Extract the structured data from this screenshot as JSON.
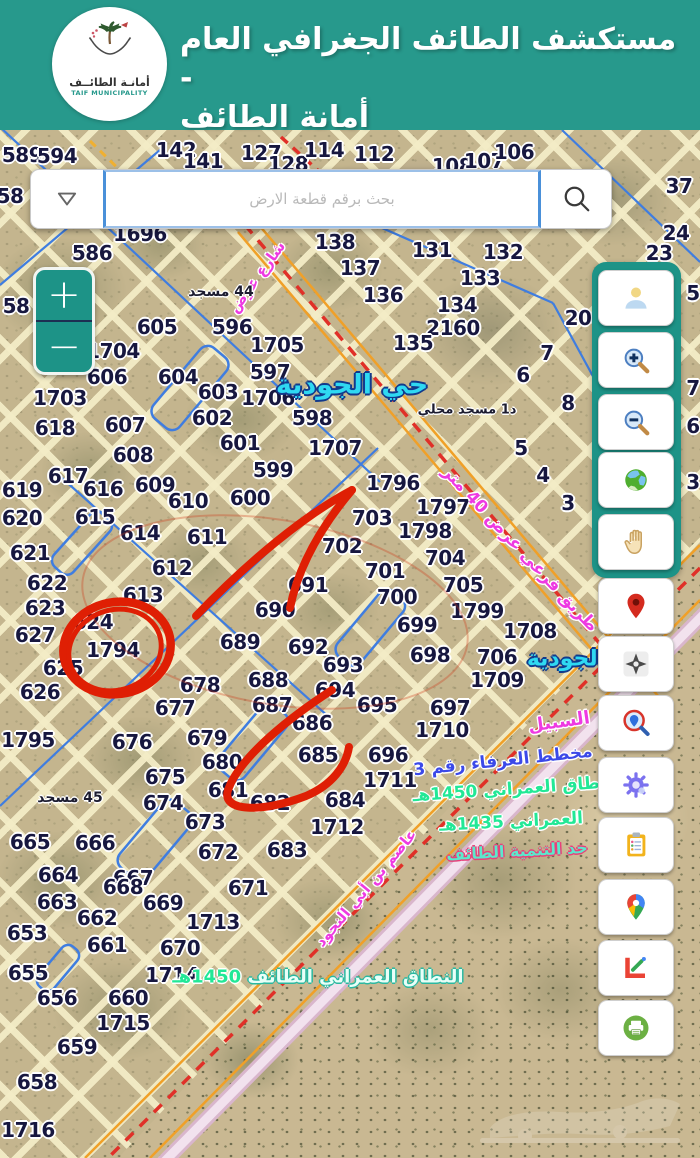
{
  "header": {
    "title_line1": "مستكشف الطائف الجغرافي العام -",
    "title_line2": "أمانة الطائف",
    "logo_text_ar": "أمانـة الطائــف",
    "logo_text_en": "TAIF MUNICIPALITY"
  },
  "search": {
    "placeholder": "بحث برقم قطعة الارض",
    "dropdown_icon": "chevron-down",
    "search_icon": "magnifier"
  },
  "zoom_control": {
    "zoom_in": "+",
    "zoom_out": "−"
  },
  "sidebar": {
    "tools": [
      {
        "name": "user-account",
        "icon": "person"
      },
      {
        "name": "zoom-in-tool",
        "icon": "magnifier-plus"
      },
      {
        "name": "zoom-out-tool",
        "icon": "magnifier-minus"
      },
      {
        "name": "basemap-globe",
        "icon": "globe"
      },
      {
        "name": "pan-tool",
        "icon": "hand"
      },
      {
        "name": "drop-marker",
        "icon": "red-pin"
      },
      {
        "name": "locate-me",
        "icon": "crosshair"
      },
      {
        "name": "search-location",
        "icon": "magnifier-pin"
      },
      {
        "name": "settings",
        "icon": "gear"
      },
      {
        "name": "report-clipboard",
        "icon": "clipboard"
      },
      {
        "name": "google-maps",
        "icon": "gmaps-pin"
      },
      {
        "name": "measure-draw",
        "icon": "measure"
      },
      {
        "name": "print",
        "icon": "printer"
      }
    ]
  },
  "map": {
    "parcel_numbers": [
      {
        "t": "589",
        "x": 22,
        "y": 155
      },
      {
        "t": "594",
        "x": 57,
        "y": 156
      },
      {
        "t": "142",
        "x": 176,
        "y": 150
      },
      {
        "t": "141",
        "x": 203,
        "y": 161
      },
      {
        "t": "127",
        "x": 261,
        "y": 153
      },
      {
        "t": "128",
        "x": 288,
        "y": 164
      },
      {
        "t": "114",
        "x": 324,
        "y": 150
      },
      {
        "t": "112",
        "x": 374,
        "y": 154
      },
      {
        "t": "108",
        "x": 452,
        "y": 166
      },
      {
        "t": "107",
        "x": 484,
        "y": 161
      },
      {
        "t": "106",
        "x": 514,
        "y": 152
      },
      {
        "t": "37",
        "x": 679,
        "y": 186
      },
      {
        "t": "24",
        "x": 676,
        "y": 233
      },
      {
        "t": "23",
        "x": 659,
        "y": 253
      },
      {
        "t": "58",
        "x": 10,
        "y": 196
      },
      {
        "t": "58",
        "x": 16,
        "y": 306
      },
      {
        "t": "586",
        "x": 92,
        "y": 253
      },
      {
        "t": "1696",
        "x": 140,
        "y": 234
      },
      {
        "t": "138",
        "x": 335,
        "y": 242
      },
      {
        "t": "137",
        "x": 360,
        "y": 268
      },
      {
        "t": "136",
        "x": 383,
        "y": 295
      },
      {
        "t": "131",
        "x": 432,
        "y": 250
      },
      {
        "t": "132",
        "x": 503,
        "y": 252
      },
      {
        "t": "133",
        "x": 480,
        "y": 278
      },
      {
        "t": "134",
        "x": 457,
        "y": 305
      },
      {
        "t": "2160",
        "x": 453,
        "y": 328
      },
      {
        "t": "135",
        "x": 413,
        "y": 343
      },
      {
        "t": "20",
        "x": 578,
        "y": 318
      },
      {
        "t": "7",
        "x": 547,
        "y": 353
      },
      {
        "t": "6",
        "x": 523,
        "y": 375
      },
      {
        "t": "8",
        "x": 568,
        "y": 403
      },
      {
        "t": "5",
        "x": 521,
        "y": 448
      },
      {
        "t": "4",
        "x": 543,
        "y": 475
      },
      {
        "t": "3",
        "x": 568,
        "y": 503
      },
      {
        "t": "5",
        "x": 693,
        "y": 293
      },
      {
        "t": "7",
        "x": 693,
        "y": 388
      },
      {
        "t": "6",
        "x": 693,
        "y": 426
      },
      {
        "t": "3",
        "x": 693,
        "y": 482
      },
      {
        "t": "605",
        "x": 157,
        "y": 327
      },
      {
        "t": "596",
        "x": 232,
        "y": 327
      },
      {
        "t": "1704",
        "x": 113,
        "y": 351
      },
      {
        "t": "606",
        "x": 107,
        "y": 377
      },
      {
        "t": "604",
        "x": 178,
        "y": 377
      },
      {
        "t": "1703",
        "x": 60,
        "y": 398
      },
      {
        "t": "603",
        "x": 218,
        "y": 392
      },
      {
        "t": "618",
        "x": 55,
        "y": 428
      },
      {
        "t": "607",
        "x": 125,
        "y": 425
      },
      {
        "t": "602",
        "x": 212,
        "y": 418
      },
      {
        "t": "601",
        "x": 240,
        "y": 443
      },
      {
        "t": "608",
        "x": 133,
        "y": 455
      },
      {
        "t": "599",
        "x": 273,
        "y": 470
      },
      {
        "t": "617",
        "x": 68,
        "y": 476
      },
      {
        "t": "616",
        "x": 103,
        "y": 489
      },
      {
        "t": "609",
        "x": 155,
        "y": 485
      },
      {
        "t": "610",
        "x": 188,
        "y": 501
      },
      {
        "t": "600",
        "x": 250,
        "y": 498
      },
      {
        "t": "619",
        "x": 22,
        "y": 490
      },
      {
        "t": "615",
        "x": 95,
        "y": 517
      },
      {
        "t": "620",
        "x": 22,
        "y": 518
      },
      {
        "t": "614",
        "x": 140,
        "y": 533
      },
      {
        "t": "611",
        "x": 207,
        "y": 537
      },
      {
        "t": "621",
        "x": 30,
        "y": 553
      },
      {
        "t": "612",
        "x": 172,
        "y": 568
      },
      {
        "t": "622",
        "x": 47,
        "y": 583
      },
      {
        "t": "613",
        "x": 143,
        "y": 595
      },
      {
        "t": "623",
        "x": 45,
        "y": 608
      },
      {
        "t": "624",
        "x": 93,
        "y": 622
      },
      {
        "t": "627",
        "x": 35,
        "y": 635
      },
      {
        "t": "1794",
        "x": 113,
        "y": 650
      },
      {
        "t": "625",
        "x": 63,
        "y": 668
      },
      {
        "t": "626",
        "x": 40,
        "y": 692
      },
      {
        "t": "690",
        "x": 275,
        "y": 610
      },
      {
        "t": "691",
        "x": 308,
        "y": 585
      },
      {
        "t": "689",
        "x": 240,
        "y": 642
      },
      {
        "t": "692",
        "x": 308,
        "y": 647
      },
      {
        "t": "693",
        "x": 343,
        "y": 665
      },
      {
        "t": "688",
        "x": 268,
        "y": 680
      },
      {
        "t": "694",
        "x": 335,
        "y": 690
      },
      {
        "t": "687",
        "x": 272,
        "y": 705
      },
      {
        "t": "677",
        "x": 175,
        "y": 708
      },
      {
        "t": "678",
        "x": 200,
        "y": 685
      },
      {
        "t": "702",
        "x": 342,
        "y": 546
      },
      {
        "t": "703",
        "x": 372,
        "y": 518
      },
      {
        "t": "701",
        "x": 385,
        "y": 571
      },
      {
        "t": "700",
        "x": 397,
        "y": 597
      },
      {
        "t": "704",
        "x": 445,
        "y": 558
      },
      {
        "t": "705",
        "x": 463,
        "y": 585
      },
      {
        "t": "1796",
        "x": 393,
        "y": 483
      },
      {
        "t": "1797",
        "x": 443,
        "y": 507
      },
      {
        "t": "1798",
        "x": 425,
        "y": 531
      },
      {
        "t": "1799",
        "x": 477,
        "y": 611
      },
      {
        "t": "699",
        "x": 417,
        "y": 625
      },
      {
        "t": "1708",
        "x": 530,
        "y": 631
      },
      {
        "t": "698",
        "x": 430,
        "y": 655
      },
      {
        "t": "706",
        "x": 497,
        "y": 657
      },
      {
        "t": "1709",
        "x": 497,
        "y": 680
      },
      {
        "t": "695",
        "x": 377,
        "y": 705
      },
      {
        "t": "697",
        "x": 450,
        "y": 708
      },
      {
        "t": "1710",
        "x": 442,
        "y": 730
      },
      {
        "t": "686",
        "x": 312,
        "y": 723
      },
      {
        "t": "685",
        "x": 318,
        "y": 755
      },
      {
        "t": "696",
        "x": 388,
        "y": 755
      },
      {
        "t": "1711",
        "x": 390,
        "y": 780
      },
      {
        "t": "684",
        "x": 345,
        "y": 800
      },
      {
        "t": "1712",
        "x": 337,
        "y": 827
      },
      {
        "t": "683",
        "x": 287,
        "y": 850
      },
      {
        "t": "1795",
        "x": 28,
        "y": 740
      },
      {
        "t": "676",
        "x": 132,
        "y": 742
      },
      {
        "t": "679",
        "x": 207,
        "y": 738
      },
      {
        "t": "680",
        "x": 222,
        "y": 762
      },
      {
        "t": "675",
        "x": 165,
        "y": 777
      },
      {
        "t": "674",
        "x": 163,
        "y": 803
      },
      {
        "t": "681",
        "x": 228,
        "y": 790
      },
      {
        "t": "682",
        "x": 270,
        "y": 803
      },
      {
        "t": "673",
        "x": 205,
        "y": 822
      },
      {
        "t": "665",
        "x": 30,
        "y": 842
      },
      {
        "t": "666",
        "x": 95,
        "y": 843
      },
      {
        "t": "672",
        "x": 218,
        "y": 852
      },
      {
        "t": "667",
        "x": 133,
        "y": 878
      },
      {
        "t": "664",
        "x": 58,
        "y": 875
      },
      {
        "t": "668",
        "x": 123,
        "y": 887
      },
      {
        "t": "671",
        "x": 248,
        "y": 888
      },
      {
        "t": "663",
        "x": 57,
        "y": 902
      },
      {
        "t": "669",
        "x": 163,
        "y": 903
      },
      {
        "t": "662",
        "x": 97,
        "y": 918
      },
      {
        "t": "1713",
        "x": 213,
        "y": 922
      },
      {
        "t": "653",
        "x": 27,
        "y": 933
      },
      {
        "t": "661",
        "x": 107,
        "y": 945
      },
      {
        "t": "670",
        "x": 180,
        "y": 948
      },
      {
        "t": "655",
        "x": 28,
        "y": 973
      },
      {
        "t": "1714",
        "x": 172,
        "y": 975
      },
      {
        "t": "656",
        "x": 57,
        "y": 998
      },
      {
        "t": "660",
        "x": 128,
        "y": 998
      },
      {
        "t": "1715",
        "x": 123,
        "y": 1023
      },
      {
        "t": "659",
        "x": 77,
        "y": 1047
      },
      {
        "t": "658",
        "x": 37,
        "y": 1082
      },
      {
        "t": "1716",
        "x": 28,
        "y": 1130
      },
      {
        "t": "597",
        "x": 270,
        "y": 372
      },
      {
        "t": "1705",
        "x": 277,
        "y": 345
      },
      {
        "t": "1706",
        "x": 268,
        "y": 398
      },
      {
        "t": "598",
        "x": 312,
        "y": 418
      },
      {
        "t": "1707",
        "x": 335,
        "y": 448
      }
    ],
    "labels": [
      {
        "t": "حي الجودية",
        "x": 352,
        "y": 385,
        "cls": "cyan",
        "size": 27,
        "rot": 0
      },
      {
        "t": "الجودية",
        "x": 566,
        "y": 659,
        "cls": "cyan",
        "size": 22,
        "rot": 0
      },
      {
        "t": "السبيل",
        "x": 559,
        "y": 722,
        "cls": "magenta",
        "size": 18,
        "rot": -8
      },
      {
        "t": "شارع عرض",
        "x": 257,
        "y": 277,
        "cls": "magenta",
        "size": 15,
        "rot": -54
      },
      {
        "t": "طريق فرعي عرض 40 متر",
        "x": 520,
        "y": 549,
        "cls": "magenta",
        "size": 17,
        "rot": 47
      },
      {
        "t": "عاصم بن أبي النجود",
        "x": 366,
        "y": 888,
        "cls": "magenta",
        "size": 15,
        "rot": -50
      },
      {
        "t": "مخطط العرفاء رقم 3",
        "x": 503,
        "y": 761,
        "cls": "bluelbl",
        "size": 17,
        "rot": -6
      },
      {
        "t": "النطاق العمراني 1450هـ",
        "x": 516,
        "y": 789,
        "cls": "greenlbl",
        "size": 17,
        "rot": -4
      },
      {
        "t": "العمراني 1435هـ",
        "x": 511,
        "y": 822,
        "cls": "greenlbl",
        "size": 17,
        "rot": -3
      },
      {
        "t": "حد التنمية الطائف",
        "x": 517,
        "y": 851,
        "cls": "tealred",
        "size": 16,
        "rot": -3
      },
      {
        "t": "44 مسجد",
        "x": 221,
        "y": 292,
        "cls": "mosque",
        "size": 14,
        "rot": 0
      },
      {
        "t": "45 مسجد",
        "x": 70,
        "y": 798,
        "cls": "mosque",
        "size": 14,
        "rot": 0
      },
      {
        "t": "د1 مسجد محلي",
        "x": 467,
        "y": 410,
        "cls": "mosque",
        "size": 13,
        "rot": 0
      }
    ],
    "boundary_label": {
      "text": "النطاق العمراني الطائف",
      "year": "1450هـ",
      "x": 318,
      "y": 977
    },
    "highlighted_parcel": "1794",
    "colors": {
      "header_teal": "#27998c",
      "control_teal": "#1d9387",
      "search_border_blue": "#4a90d9",
      "parcel_line_yellow": "#f3ecc6",
      "parcel_number_navy": "#17173f",
      "annotation_red": "#df1f04",
      "street_magenta": "#ee3ae2",
      "district_cyan": "#2fd9f2",
      "boundary_green": "#22e896",
      "plan_blue": "#3b49e8",
      "road_orange": "#f0a028",
      "road_pink": "#ecd0e0"
    }
  }
}
